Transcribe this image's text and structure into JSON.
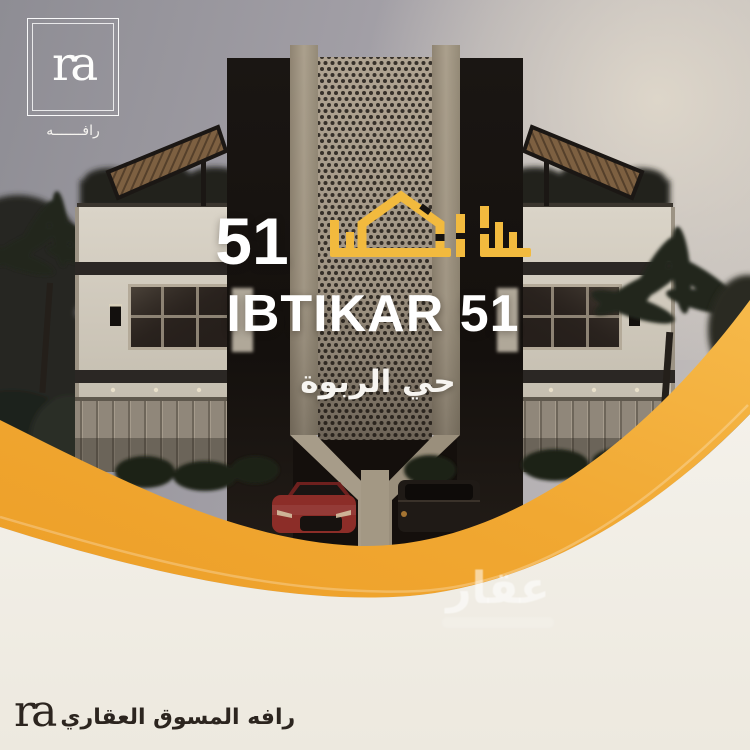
{
  "header": {
    "logo_mark": "ra",
    "logo_name_ar": "رافـــــــه"
  },
  "title": {
    "unit_number": "51",
    "project_name_en": "IBTIKAR 51",
    "district_ar": "حي الربوة"
  },
  "watermark": {
    "text_ar": "عقار"
  },
  "footer": {
    "logo_mark": "ra",
    "tagline_ar": "رافه المسوق العقاري"
  },
  "colors": {
    "accent_yellow": "#F1A832",
    "gold": "#F2BA3E",
    "cream": "#F1EEE6",
    "text_white": "#FFFFFF",
    "text_dark": "#2C251F",
    "sky_gray": "#A19EA5",
    "facade_light": "#D6D0C4",
    "facade_dark": "#2B2724",
    "car_red": "#8C2D28"
  }
}
